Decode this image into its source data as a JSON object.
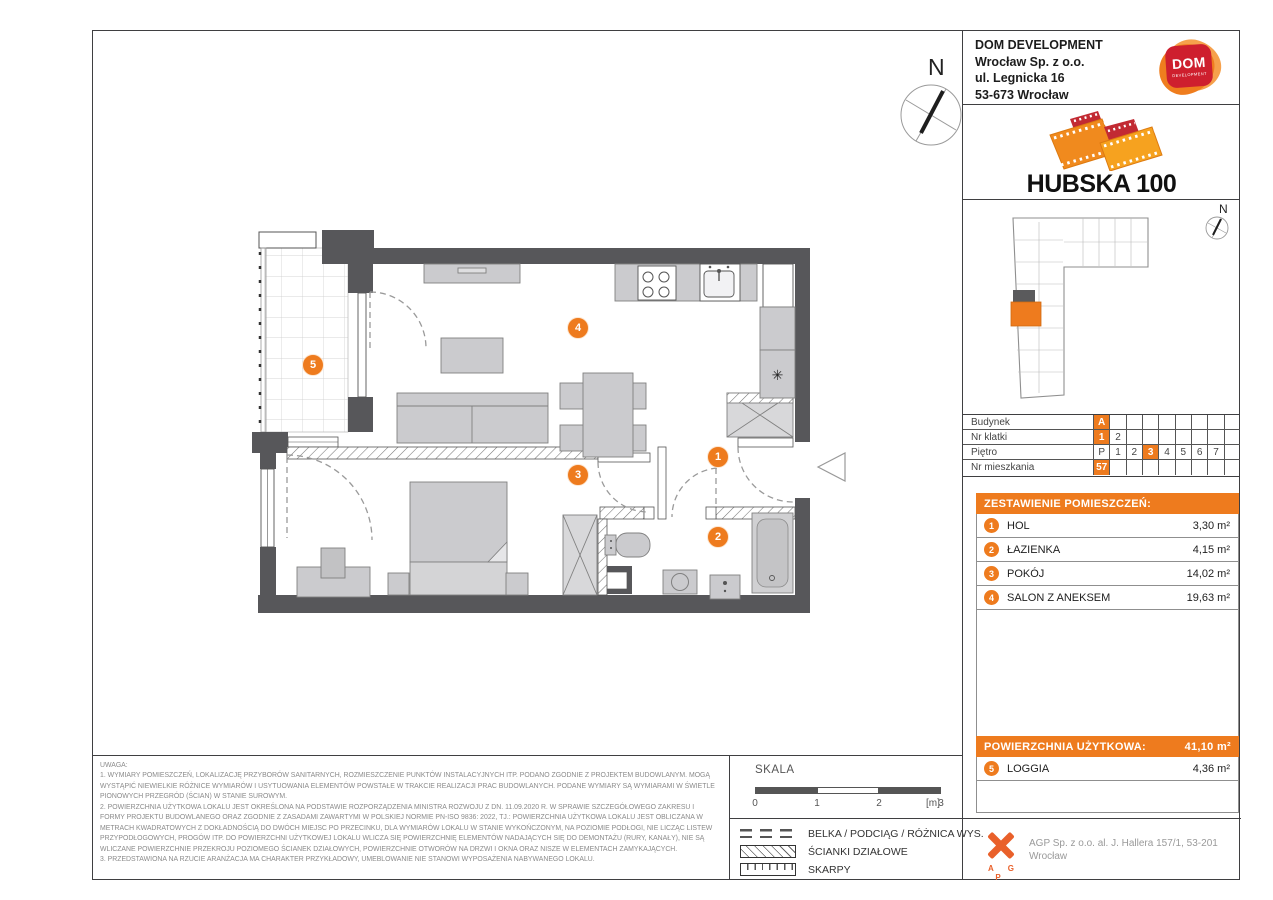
{
  "developer": {
    "name": "DOM DEVELOPMENT",
    "address_line1": "Wrocław Sp. z o.o.",
    "address_line2": "ul. Legnicka 16",
    "address_line3": "53-673 Wrocław",
    "logo_main": "DOM",
    "logo_sub": "DEVELOPMENT"
  },
  "project": {
    "title": "HUBSKA 100"
  },
  "compass": {
    "label": "N"
  },
  "unit_table": {
    "rows": [
      {
        "label": "Budynek",
        "cells": [
          "A",
          "",
          "",
          "",
          "",
          "",
          "",
          "",
          ""
        ],
        "active_index": 0
      },
      {
        "label": "Nr klatki",
        "cells": [
          "1",
          "2",
          "",
          "",
          "",
          "",
          "",
          "",
          ""
        ],
        "active_index": 0
      },
      {
        "label": "Piętro",
        "cells": [
          "P",
          "1",
          "2",
          "3",
          "4",
          "5",
          "6",
          "7",
          ""
        ],
        "active_index": 3
      },
      {
        "label": "Nr mieszkania",
        "cells": [
          "57",
          "",
          "",
          "",
          "",
          "",
          "",
          "",
          ""
        ],
        "active_index": 0
      }
    ]
  },
  "room_schedule": {
    "title": "ZESTAWIENIE POMIESZCZEŃ:",
    "rooms": [
      {
        "no": "1",
        "name": "HOL",
        "area": "3,30 m²"
      },
      {
        "no": "2",
        "name": "ŁAZIENKA",
        "area": "4,15 m²"
      },
      {
        "no": "3",
        "name": "POKÓJ",
        "area": "14,02 m²"
      },
      {
        "no": "4",
        "name": "SALON Z ANEKSEM",
        "area": "19,63 m²"
      }
    ],
    "total_label": "POWIERZCHNIA UŻYTKOWA:",
    "total_value": "41,10 m²",
    "balcony": {
      "no": "5",
      "name": "LOGGIA",
      "area": "4,36 m²"
    }
  },
  "plan": {
    "markers": [
      {
        "no": "1"
      },
      {
        "no": "2"
      },
      {
        "no": "3"
      },
      {
        "no": "4"
      },
      {
        "no": "5"
      }
    ]
  },
  "notes": {
    "title": "UWAGA:",
    "items": [
      "1. WYMIARY POMIESZCZEŃ, LOKALIZACJĘ PRZYBORÓW SANITARNYCH, ROZMIESZCZENIE PUNKTÓW INSTALACYJNYCH ITP. PODANO ZGODNIE Z PROJEKTEM BUDOWLANYM. MOGĄ WYSTĄPIĆ NIEWIELKIE RÓŻNICE WYMIARÓW I USYTUOWANIA ELEMENTÓW POWSTAŁE W TRAKCIE REALIZACJI PRAC BUDOWLANYCH. PODANE WYMIARY SĄ WYMIARAMI W ŚWIETLE PIONOWYCH PRZEGRÓD (ŚCIAN) W STANIE SUROWYM.",
      "2. POWIERZCHNIA UŻYTKOWA LOKALU JEST OKREŚLONA NA PODSTAWIE ROZPORZĄDZENIA MINISTRA ROZWOJU Z DN. 11.09.2020 R. W SPRAWIE SZCZEGÓŁOWEGO ZAKRESU I FORMY PROJEKTU BUDOWLANEGO ORAZ ZGODNIE Z ZASADAMI ZAWARTYMI W POLSKIEJ NORMIE PN-ISO 9836: 2022, TJ.: POWIERZCHNIA UŻYTKOWA LOKALU JEST OBLICZANA W METRACH KWADRATOWYCH Z DOKŁADNOŚCIĄ DO DWÓCH MIEJSC PO PRZECINKU, DLA WYMIARÓW LOKALU W STANIE WYKOŃCZONYM, NA POZIOMIE PODŁOGI, NIE LICZĄC LISTEW PRZYPODŁOGOWYCH, PROGÓW ITP. DO POWIERZCHNI UŻYTKOWEJ LOKALU WLICZA SIĘ POWIERZCHNIĘ ELEMENTÓW NADAJĄCYCH SIĘ DO DEMONTAŻU (RURY, KANAŁY), NIE SĄ WLICZANE POWIERZCHNIE PRZEKROJU POZIOMEGO ŚCIANEK DZIAŁOWYCH, POWIERZCHNIE OTWORÓW NA DRZWI I OKNA ORAZ NISZE W ELEMENTACH ZAMYKAJĄCYCH.",
      "3. PRZEDSTAWIONA NA RZUCIE ARANŻACJA MA CHARAKTER PRZYKŁADOWY, UMEBLOWANIE NIE STANOWI WYPOSAŻENIA NABYWANEGO LOKALU."
    ]
  },
  "scale": {
    "label": "SKALA",
    "ticks": [
      "0",
      "1",
      "2",
      "3"
    ],
    "unit": "[m]"
  },
  "legend": {
    "items": [
      {
        "label": "BELKA / PODCIĄG / RÓŻNICA WYS."
      },
      {
        "label": "ŚCIANKI DZIAŁOWE"
      },
      {
        "label": "SKARPY"
      }
    ]
  },
  "architect": {
    "logo_letters": "A G P",
    "address": "AGP Sp. z o.o. al. J. Hallera 157/1, 53-201 Wrocław"
  },
  "colors": {
    "accent": "#EE7B1E",
    "wall": "#57575A",
    "furniture": "#CBCBCE"
  }
}
